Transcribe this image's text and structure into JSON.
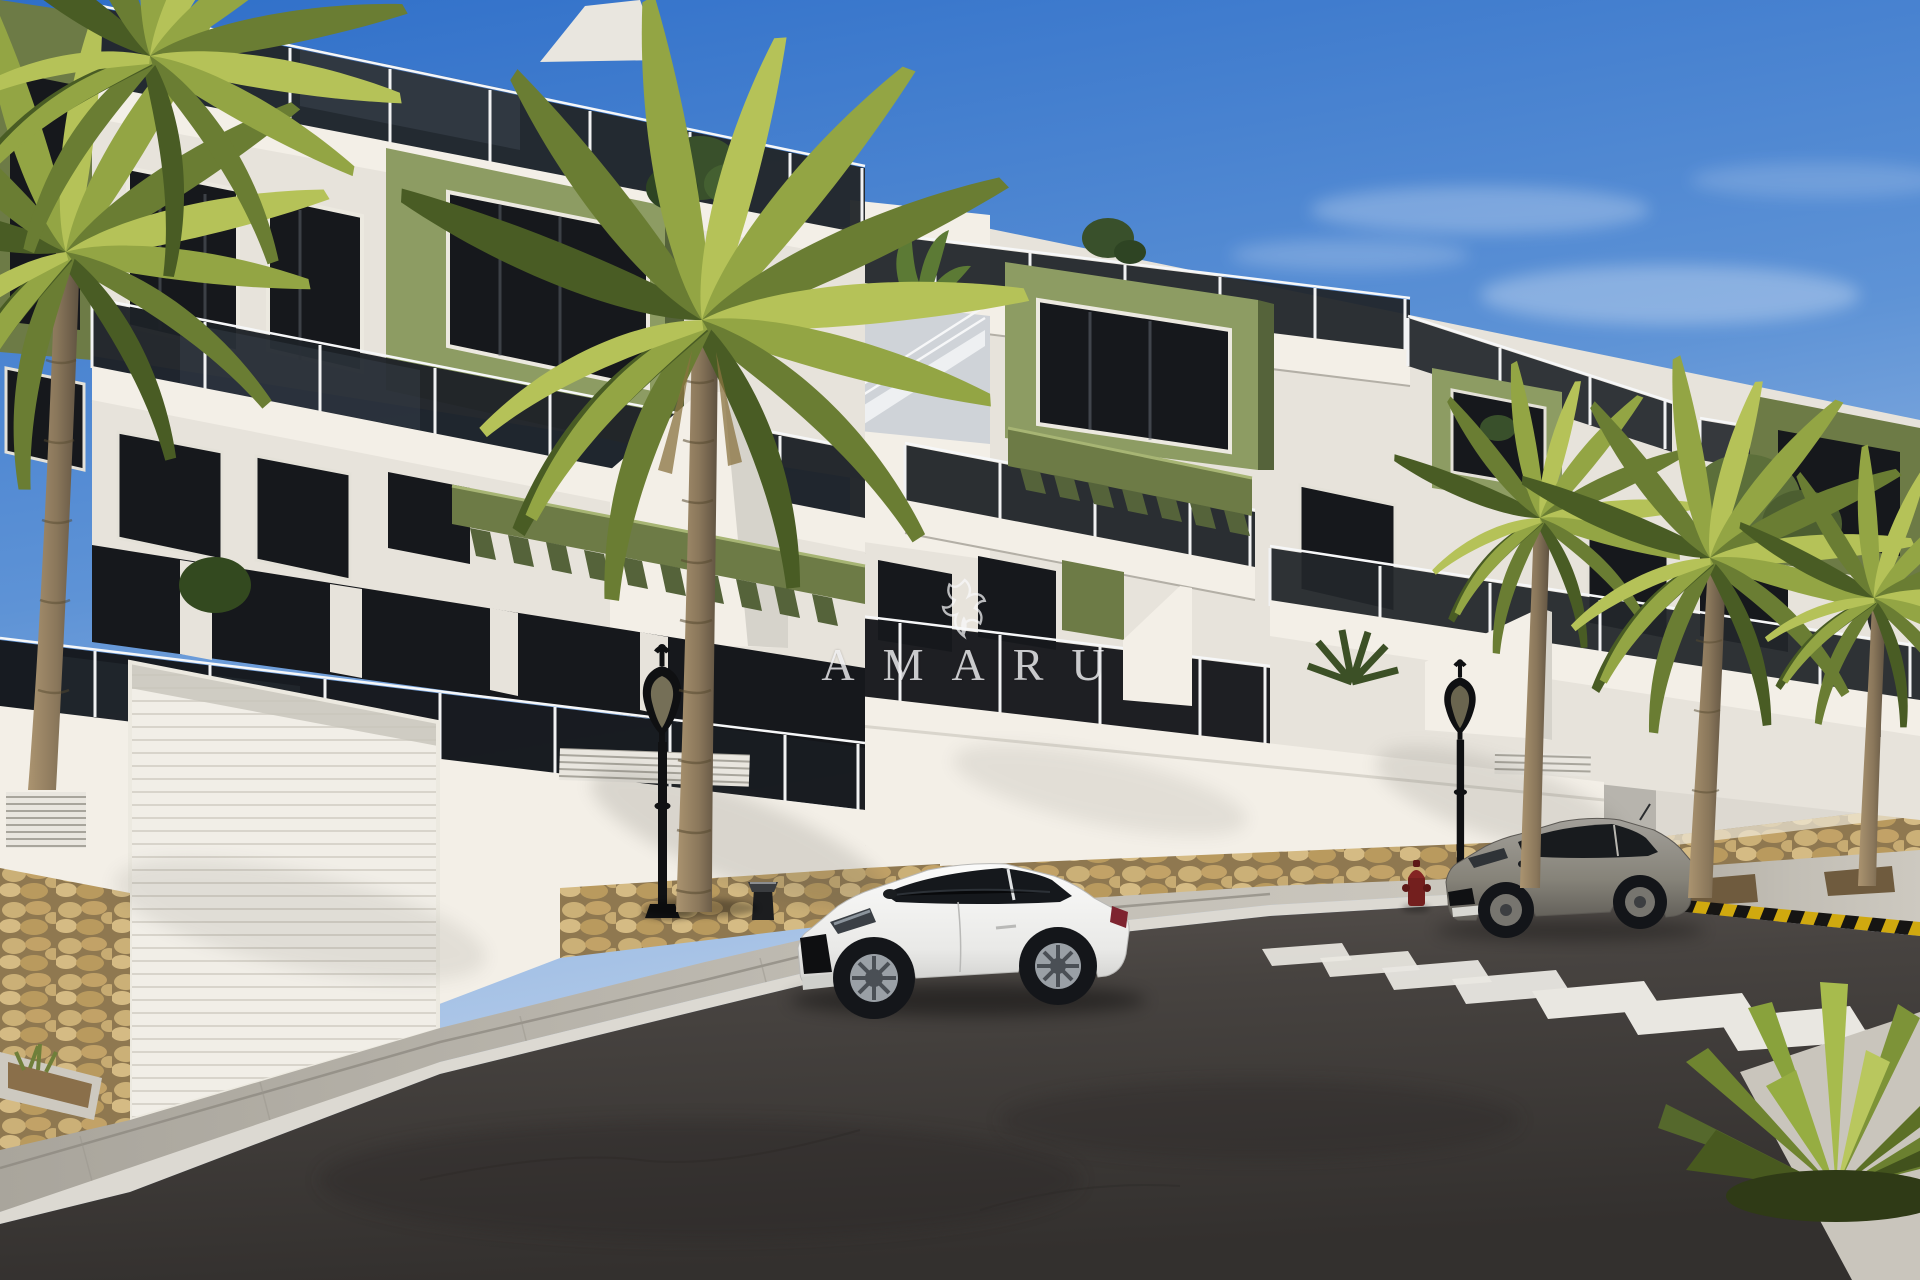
{
  "watermark": {
    "brand": "AMARU",
    "logo": "griffin-crest"
  },
  "scene": {
    "setting": "3D architectural render of a new-build residential street on a sunny day",
    "objects": [
      "left-apartment-building",
      "right-apartment-building",
      "far-street-block",
      "roof-terrace-glass-railing",
      "smoked-glass-balcony-railings",
      "olive-accent-volumes",
      "green-pergola-slats",
      "garage-door-left",
      "garage-door-far",
      "ventilation-grilles",
      "stone-clad-base-wall",
      "paved-sidewalk",
      "asphalt-road",
      "zebra-crosswalk",
      "yellow-black-warning-curb",
      "ornate-street-lamps",
      "fire-hydrant",
      "bollard",
      "white-coupe-car",
      "gray-coupe-car",
      "palm-trees",
      "yucca-plant",
      "planter-bed",
      "amaru-watermark"
    ]
  },
  "palette": {
    "sky_top": "#2f6fc9",
    "sky_horizon": "#c7d9ef",
    "facade_white": "#f3efe7",
    "facade_shadow": "#c3c6c9",
    "accent_olive": "#8d9c63",
    "accent_olive_dark": "#6d7b46",
    "glass_dark": "#16181c",
    "stone_tan": "#c7a76e",
    "road_asphalt": "#3f3b39",
    "sidewalk": "#b7b3aa",
    "crosswalk_white": "#e9e7e1",
    "curb_warning_yellow": "#d0a90f",
    "palm_green": "#7d913d",
    "palm_trunk": "#9b8a6e",
    "car_white": "#f4f4f2",
    "car_gray": "#8f8c86",
    "lamp_black": "#131416",
    "hydrant_red": "#731f1e"
  }
}
